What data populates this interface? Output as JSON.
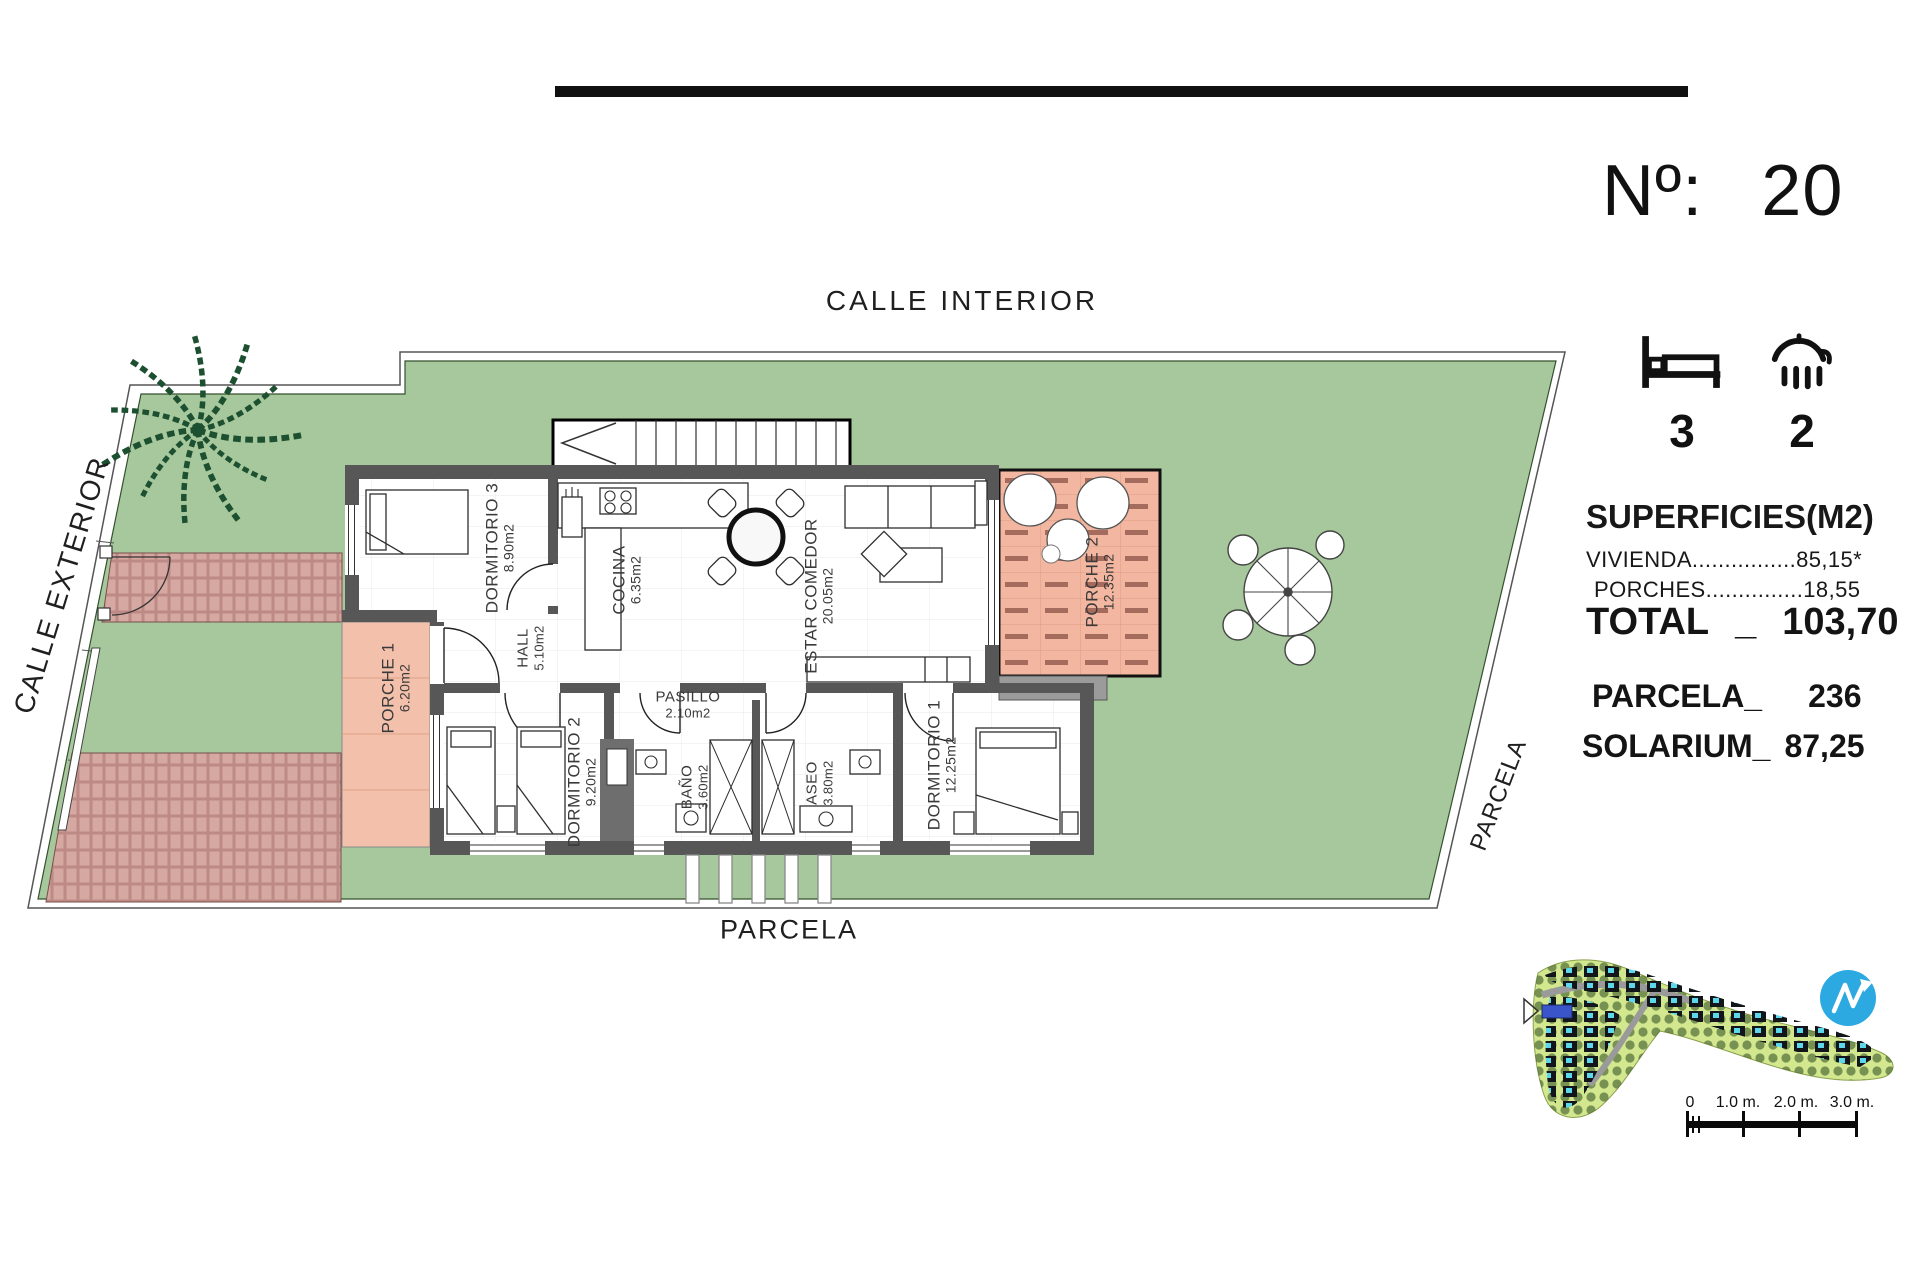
{
  "plan_labels": {
    "calle_interior": "CALLE INTERIOR",
    "calle_exterior": "CALLE EXTERIOR",
    "parcela_bottom": "PARCELA",
    "parcela_right": "PARCELA"
  },
  "rooms": [
    {
      "name": "DORMITORIO 3",
      "area": "8.90m2"
    },
    {
      "name": "COCINA",
      "area": "6.35m2"
    },
    {
      "name": "ESTAR COMEDOR",
      "area": "20.05m2"
    },
    {
      "name": "HALL",
      "area": "5.10m2"
    },
    {
      "name": "PASILLO",
      "area": "2.10m2"
    },
    {
      "name": "DORMITORIO 2",
      "area": "9.20m2"
    },
    {
      "name": "BAÑO",
      "area": "3.60m2"
    },
    {
      "name": "ASEO",
      "area": "3.80m2"
    },
    {
      "name": "DORMITORIO 1",
      "area": "12.25m2"
    },
    {
      "name": "PORCHE 1",
      "area": "6.20m2"
    },
    {
      "name": "PORCHE 2",
      "area": "12.35m2"
    }
  ],
  "info_panel": {
    "number_label": "Nº:",
    "number_value": "20",
    "bedrooms": "3",
    "bathrooms": "2",
    "surfaces_title": "SUPERFICIES(M2)",
    "rows": [
      {
        "label": "VIVIENDA",
        "dots": "................",
        "value": "85,15*"
      },
      {
        "label": "PORCHES",
        "dots": "...............",
        "value": "18,55"
      }
    ],
    "total_label": "TOTAL",
    "total_sep": "_",
    "total_value": "103,70",
    "parcela_label": "PARCELA_",
    "parcela_value": "236",
    "solarium_label": "SOLARIUM_",
    "solarium_value": "87,25"
  },
  "scale_bar": {
    "ticks": [
      "0",
      "1.0 m.",
      "2.0 m.",
      "3.0 m."
    ]
  },
  "icons": {
    "bed": "bed-icon",
    "shower": "shower-icon",
    "north": "north-arrow-logo",
    "palm": "palm-tree-icon"
  },
  "colors": {
    "garden_green": "#a7c89c",
    "porch_salmon": "#f3bda5",
    "brick_red": "#d6a8a2",
    "brick_mortar": "#bd8a85",
    "wall_gray": "#575757",
    "logo_blue": "#2ba9e0",
    "pool_cyan": "#5cd8ea",
    "site_green": "#d3e88e",
    "marker_blue": "#3a55c9"
  }
}
